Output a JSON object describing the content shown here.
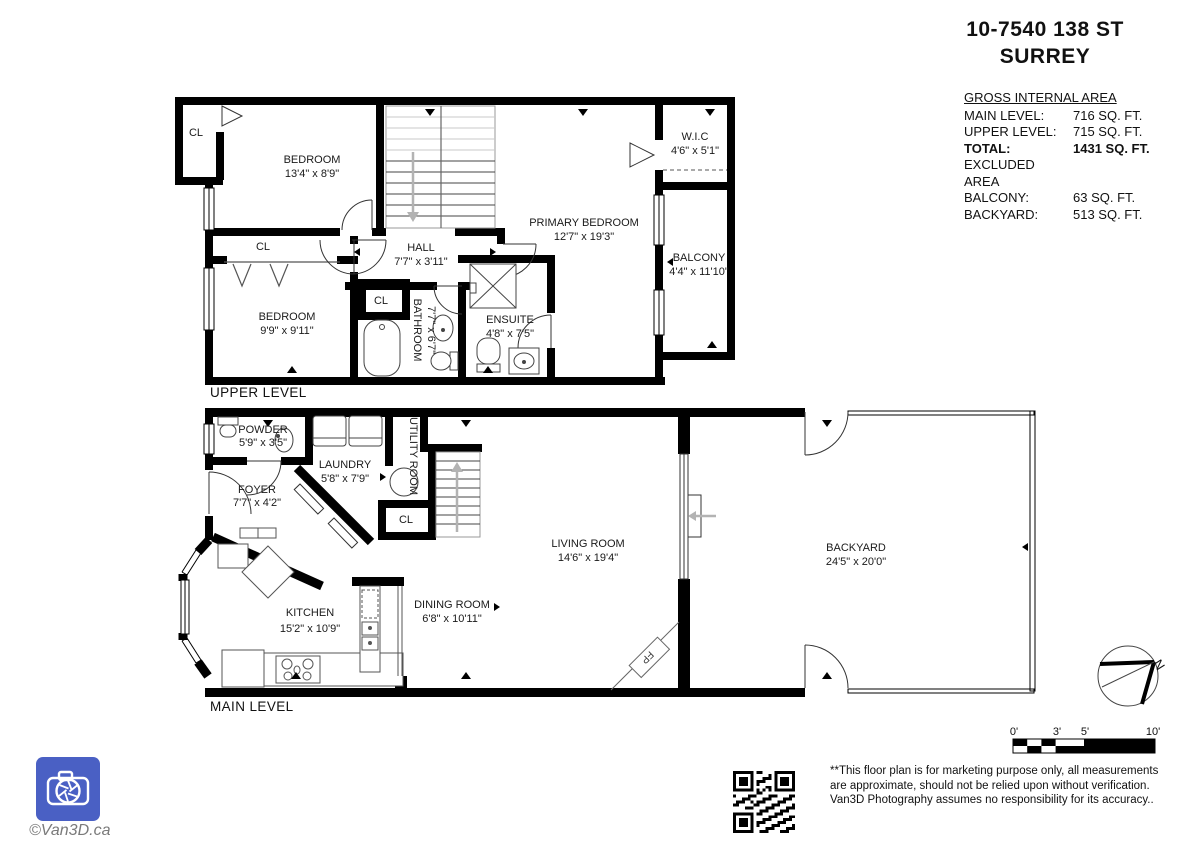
{
  "header": {
    "address_line1": "10-7540 138 ST",
    "address_line2": "SURREY"
  },
  "area_summary": {
    "title": "GROSS INTERNAL AREA",
    "rows": [
      {
        "label": "MAIN LEVEL:",
        "value": "716 SQ. FT."
      },
      {
        "label": "UPPER LEVEL:",
        "value": "715 SQ. FT."
      },
      {
        "label": "TOTAL:",
        "value": "1431 SQ. FT."
      },
      {
        "label": "EXCLUDED AREA",
        "value": ""
      },
      {
        "label": "BALCONY:",
        "value": "63 SQ. FT."
      },
      {
        "label": "BACKYARD:",
        "value": "513 SQ. FT."
      }
    ]
  },
  "upper_level": {
    "label": "UPPER LEVEL",
    "rooms": {
      "closet_top": {
        "name": "CL"
      },
      "bedroom1": {
        "name": "BEDROOM",
        "dims": "13'4\" x 8'9\""
      },
      "closet_mid": {
        "name": "CL"
      },
      "bedroom2": {
        "name": "BEDROOM",
        "dims": "9'9\" x 9'11\""
      },
      "hall": {
        "name": "HALL",
        "dims": "7'7\" x 3'11\""
      },
      "closet_small": {
        "name": "CL"
      },
      "bathroom": {
        "name": "BATHROOM",
        "dims": "7'7\" x 6'7\""
      },
      "ensuite": {
        "name": "ENSUITE",
        "dims": "4'8\" x 7'5\""
      },
      "primary": {
        "name": "PRIMARY BEDROOM",
        "dims": "12'7\" x 19'3\""
      },
      "wic": {
        "name": "W.I.C",
        "dims": "4'6\" x 5'1\""
      },
      "balcony": {
        "name": "BALCONY",
        "dims": "4'4\" x 11'10\""
      }
    }
  },
  "main_level": {
    "label": "MAIN LEVEL",
    "rooms": {
      "powder": {
        "name": "POWDER",
        "dims": "5'9\" x 3'5\""
      },
      "laundry": {
        "name": "LAUNDRY",
        "dims": "5'8\" x 7'9\""
      },
      "utility": {
        "name": "UTILITY ROOM"
      },
      "foyer": {
        "name": "FOYER",
        "dims": "7'7\" x 4'2\""
      },
      "closet": {
        "name": "CL"
      },
      "kitchen": {
        "name": "KITCHEN",
        "dims": "15'2\" x 10'9\""
      },
      "dining": {
        "name": "DINING ROOM",
        "dims": "6'8\" x 10'11\""
      },
      "living": {
        "name": "LIVING ROOM",
        "dims": "14'6\" x 19'4\""
      },
      "backyard": {
        "name": "BACKYARD",
        "dims": "24'5\" x 20'0\""
      },
      "fireplace": {
        "name": "FP"
      }
    }
  },
  "scale_bar": {
    "labels": [
      "0'",
      "3'",
      "5'",
      "10'"
    ]
  },
  "compass": {
    "north_label": "N"
  },
  "footer": {
    "copyright": "©Van3D.ca",
    "disclaimer": "**This floor plan is for marketing purpose only, all measurements are approximate, should not be relied upon without verification. Van3D Photography assumes no responsibility for its accuracy.."
  },
  "colors": {
    "wall": "#000000",
    "logo_blue": "#4a60c4",
    "stair_arrow_gray": "#b3b3b3",
    "text": "#1a1a1a"
  }
}
